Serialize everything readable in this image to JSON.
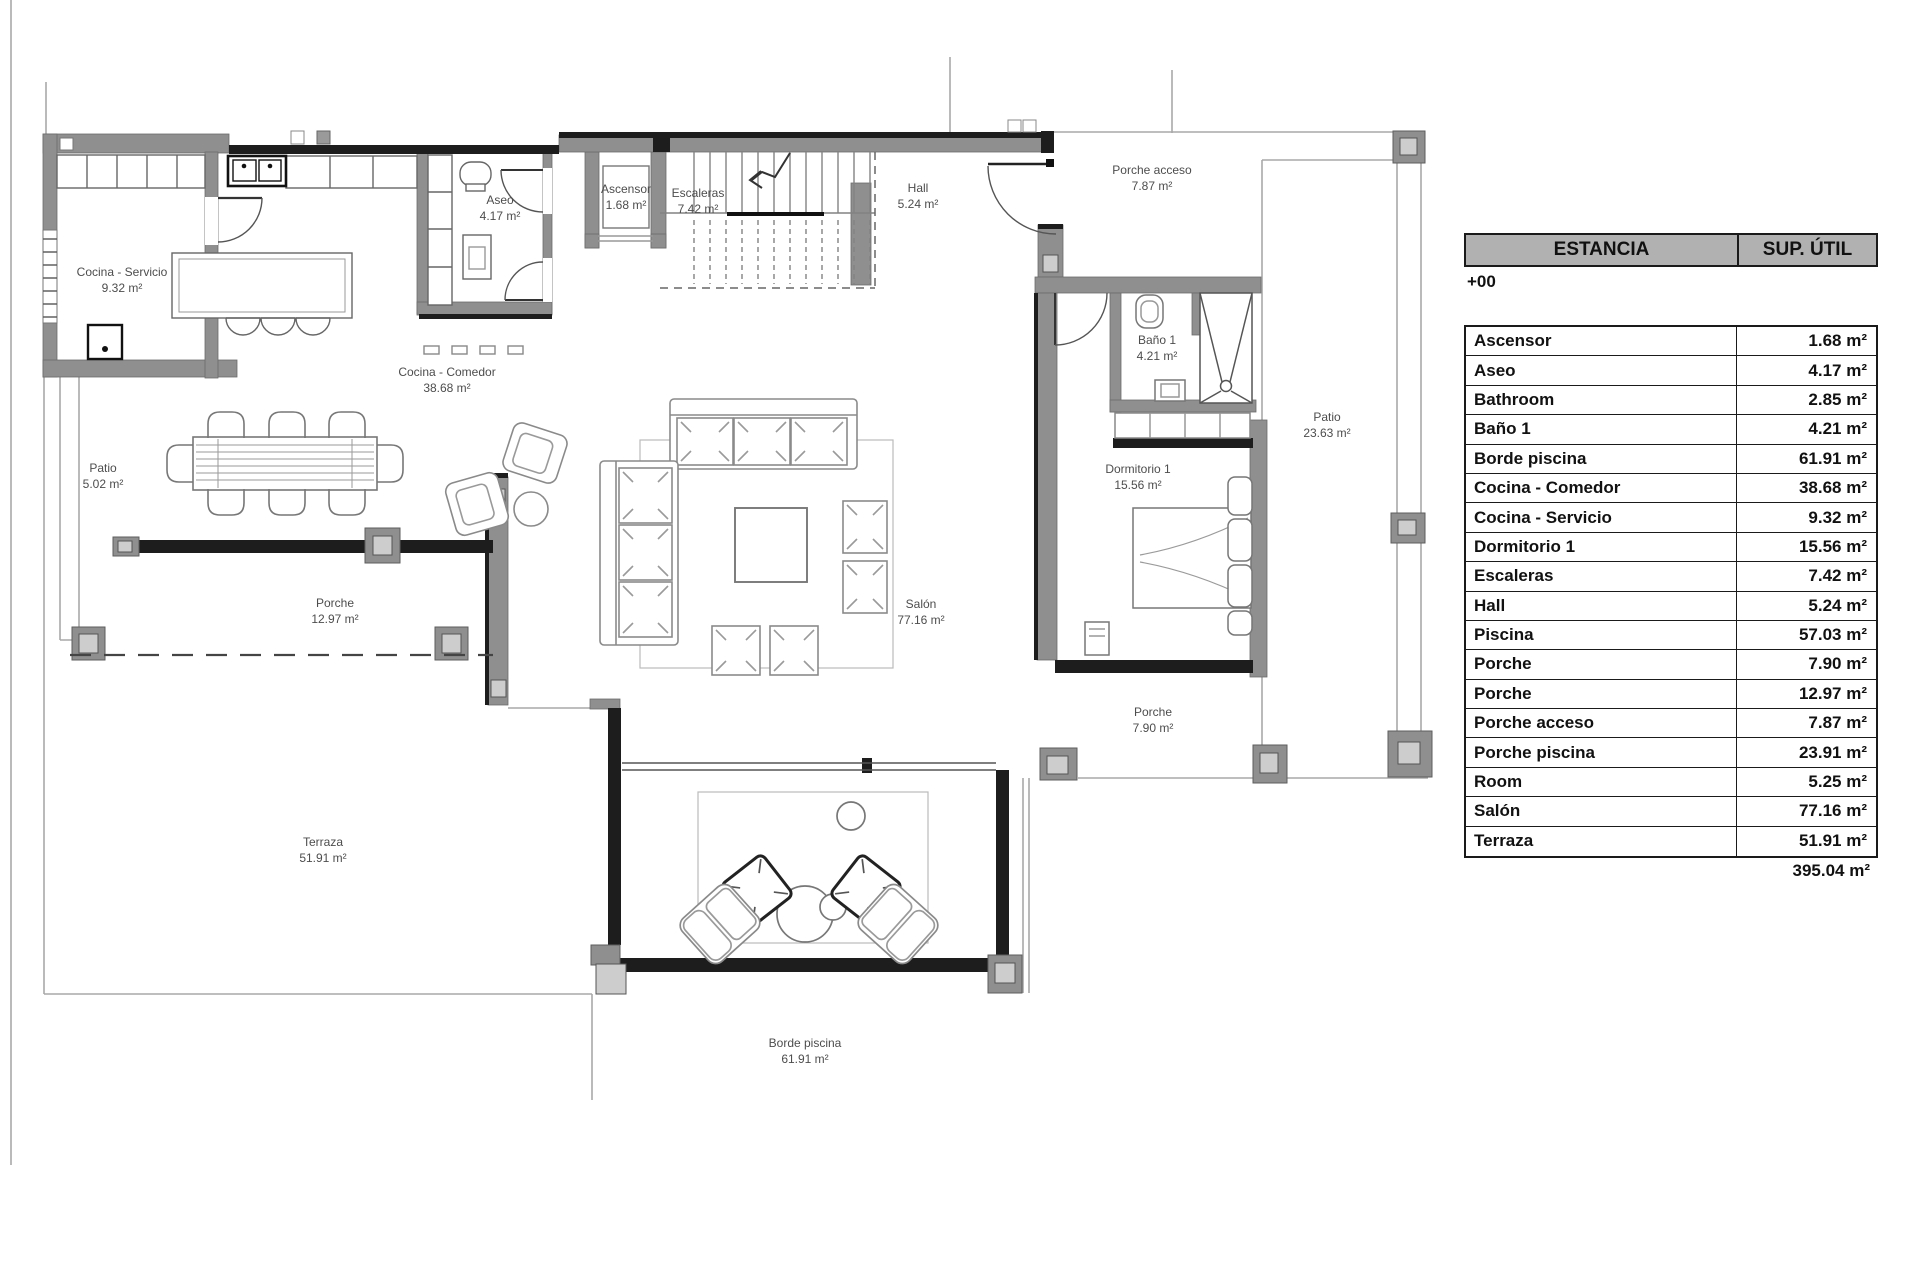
{
  "plan": {
    "labels": [
      {
        "name": "Cocina - Servicio",
        "area": "9.32 m²"
      },
      {
        "name": "Aseo",
        "area": "4.17 m²"
      },
      {
        "name": "Ascensor",
        "area": "1.68 m²"
      },
      {
        "name": "Escaleras",
        "area": "7.42 m²"
      },
      {
        "name": "Hall",
        "area": "5.24 m²"
      },
      {
        "name": "Porche acceso",
        "area": "7.87 m²"
      },
      {
        "name": "Cocina - Comedor",
        "area": "38.68 m²"
      },
      {
        "name": "Baño 1",
        "area": "4.21 m²"
      },
      {
        "name": "Patio",
        "area": "23.63 m²"
      },
      {
        "name": "Dormitorio 1",
        "area": "15.56 m²"
      },
      {
        "name": "Patio",
        "area": "5.02 m²"
      },
      {
        "name": "Porche",
        "area": "12.97 m²"
      },
      {
        "name": "Salón",
        "area": "77.16 m²"
      },
      {
        "name": "Porche",
        "area": "7.90 m²"
      },
      {
        "name": "Terraza",
        "area": "51.91 m²"
      },
      {
        "name": "Borde piscina",
        "area": "61.91 m²"
      }
    ]
  },
  "table": {
    "title": "ESTANCIA",
    "area_header": "SUP. ÚTIL",
    "level": "+00",
    "rows": [
      {
        "label": "Ascensor",
        "value": "1.68 m²"
      },
      {
        "label": "Aseo",
        "value": "4.17 m²"
      },
      {
        "label": "Bathroom",
        "value": "2.85 m²"
      },
      {
        "label": "Baño 1",
        "value": "4.21 m²"
      },
      {
        "label": "Borde piscina",
        "value": "61.91 m²"
      },
      {
        "label": "Cocina - Comedor",
        "value": "38.68 m²"
      },
      {
        "label": "Cocina - Servicio",
        "value": "9.32 m²"
      },
      {
        "label": "Dormitorio 1",
        "value": "15.56 m²"
      },
      {
        "label": "Escaleras",
        "value": "7.42 m²"
      },
      {
        "label": "Hall",
        "value": "5.24 m²"
      },
      {
        "label": "Piscina",
        "value": "57.03 m²"
      },
      {
        "label": "Porche",
        "value": "7.90 m²"
      },
      {
        "label": "Porche",
        "value": "12.97 m²"
      },
      {
        "label": "Porche acceso",
        "value": "7.87 m²"
      },
      {
        "label": "Porche piscina",
        "value": "23.91 m²"
      },
      {
        "label": "Room",
        "value": "5.25 m²"
      },
      {
        "label": "Salón",
        "value": "77.16 m²"
      },
      {
        "label": "Terraza",
        "value": "51.91 m²"
      }
    ],
    "total": "395.04 m²"
  }
}
